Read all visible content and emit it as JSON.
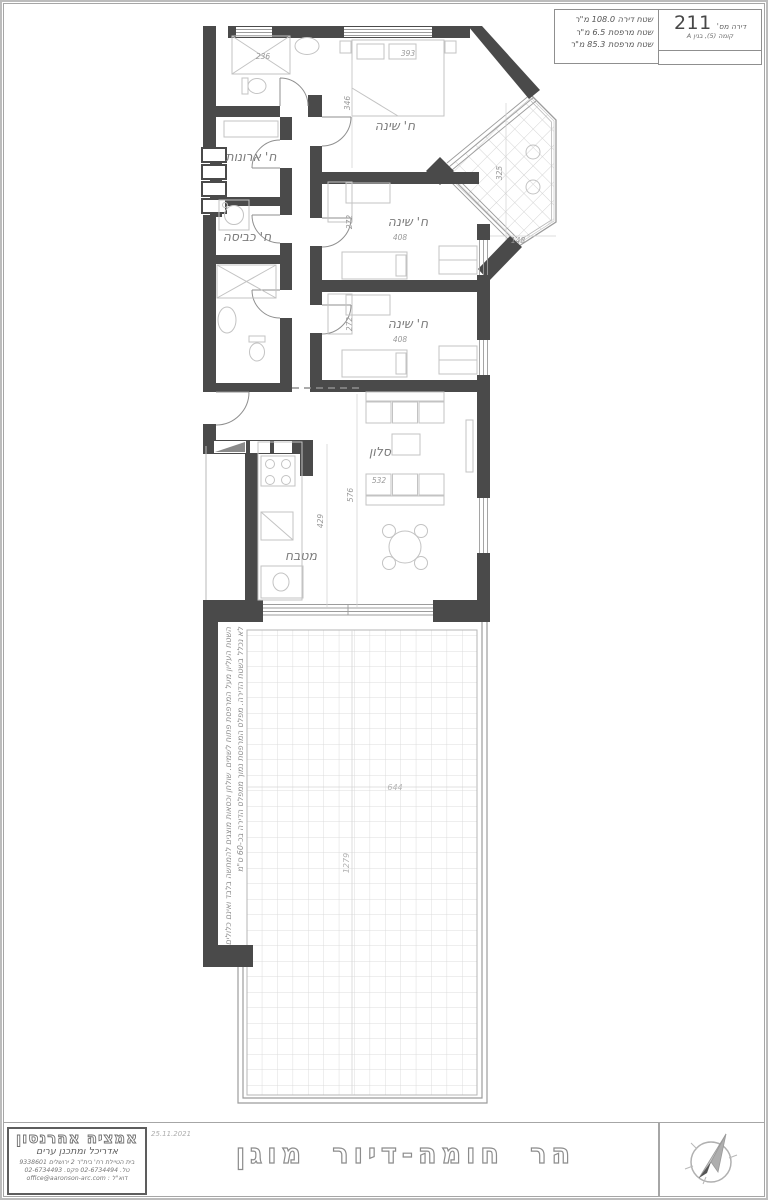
{
  "title_block": {
    "apartment_label": "דירה מס'",
    "apartment_number": "211",
    "floor_info": "קומה (5), בנין A",
    "area_line1": "שטח דירה 108.0 מ\"ר",
    "area_line2": "שטח מרפסת 6.5 מ\"ר",
    "area_line3": "שטח מרפסת 85.3 מ\"ר"
  },
  "plan": {
    "rooms": {
      "bedroom_master": "ח' שינה",
      "bedroom_2": "ח' שינה",
      "bedroom_3": "ח' שינה",
      "closet": "ח' ארונות",
      "laundry": "ח' כביסה",
      "living": "סלון",
      "kitchen": "מטבח"
    },
    "dims": {
      "shower": "236",
      "bed1_w": "393",
      "bed1_h": "346",
      "bed2_w": "408",
      "bed2_h": "272",
      "bed3_w": "408",
      "bed3_h": "272",
      "bay_h": "325",
      "bay_w": "148",
      "living_w": "532",
      "living_h": "576",
      "kitchen_h": "429",
      "terrace_w": "644",
      "terrace_h": "1279"
    },
    "terrace_note_1": "השטח העליון מעל המרפסת פתוח לשמים. שולחן וכסאות מוצגים להמחשה בלבד ואינם כלולים",
    "terrace_note_2": "לא נכלל בשטח הדירה. מפלס המרפסת נמוך ממפלס הדירה בכ-60 ס\"מ"
  },
  "footer": {
    "date": "25.11.2021",
    "project_title": "הר חומה-דיור מוגן",
    "architect": {
      "name": "אמציה אהרנסון",
      "profession": "אדריכל ומתכנן ערים",
      "address": "בית הטיילת רח' בית\"ר 2 ירושלים 9338601",
      "phones": "טל. 02-6734494 פקס. 02-6734493",
      "email": "דוא\"ל : office@aaronson-arc.com"
    }
  },
  "colors": {
    "wall": "#4a4a4a",
    "furniture": "#c3c3c3",
    "frame": "#a6a6a6",
    "dim_text": "#9a9a9a",
    "grid": "#dcdcdc"
  }
}
